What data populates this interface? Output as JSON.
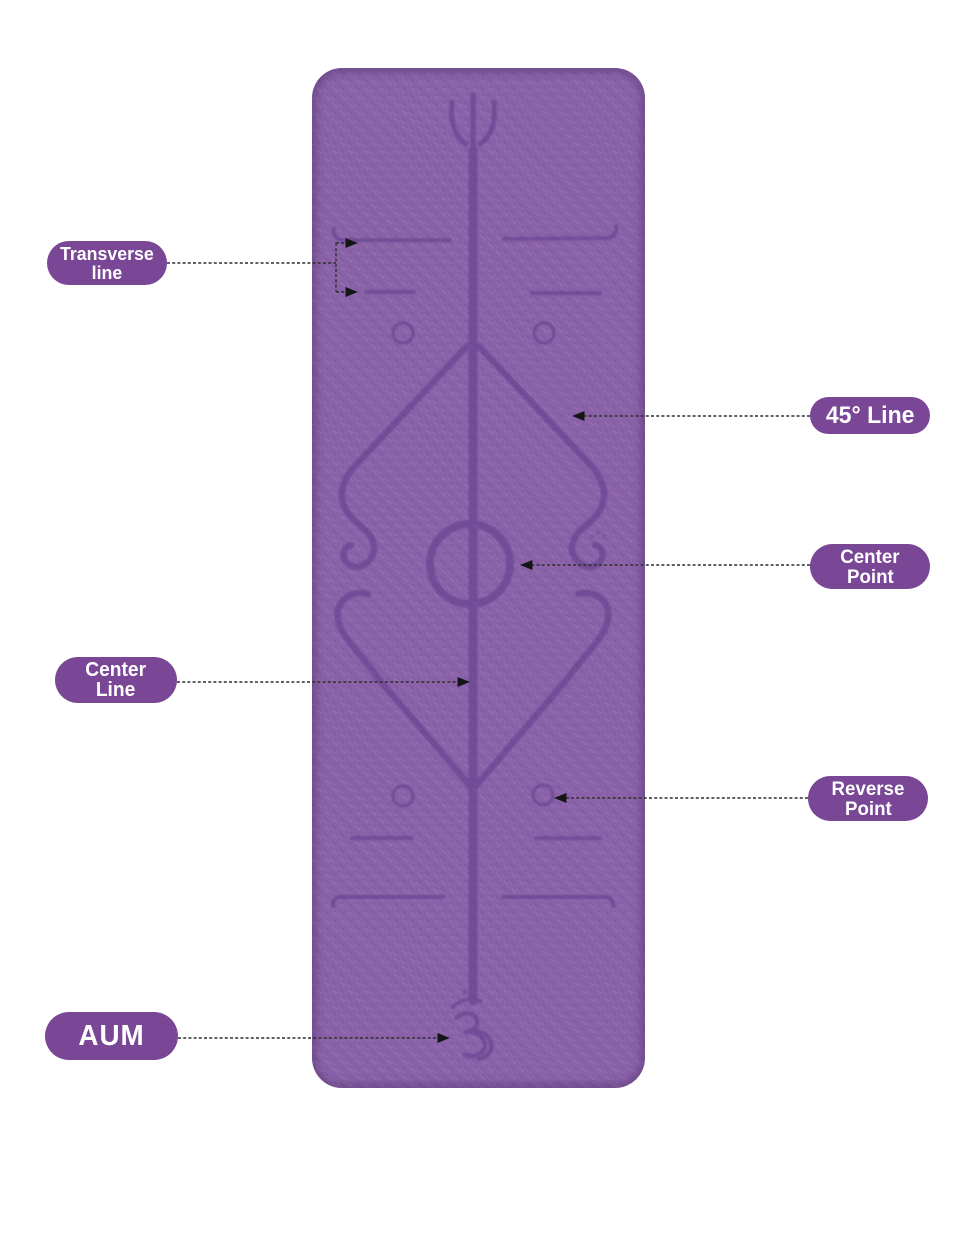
{
  "colors": {
    "mat": "#8a62a8",
    "mat_texture_light": "#9d78ba",
    "mat_texture_dark": "#7b54a0",
    "engraving": "#66408f",
    "edge_shade": "#42275f",
    "label_bg": "#7a4696",
    "label_text": "#ffffff",
    "leader": "#2e2e2e",
    "background": "#ffffff"
  },
  "mat": {
    "description": "purple yoga mat with engraved body-alignment guide",
    "symbols": [
      "trident-icon",
      "om-icon"
    ]
  },
  "annotations": [
    {
      "id": "transverse-line",
      "label_lines": [
        "Transverse",
        "line"
      ]
    },
    {
      "id": "45-line",
      "label_lines": [
        "45° Line"
      ]
    },
    {
      "id": "center-point",
      "label_lines": [
        "Center",
        "Point"
      ]
    },
    {
      "id": "center-line",
      "label_lines": [
        "Center",
        "Line"
      ]
    },
    {
      "id": "reverse-point",
      "label_lines": [
        "Reverse",
        "Point"
      ]
    },
    {
      "id": "aum",
      "label_lines": [
        "AUM"
      ]
    }
  ]
}
